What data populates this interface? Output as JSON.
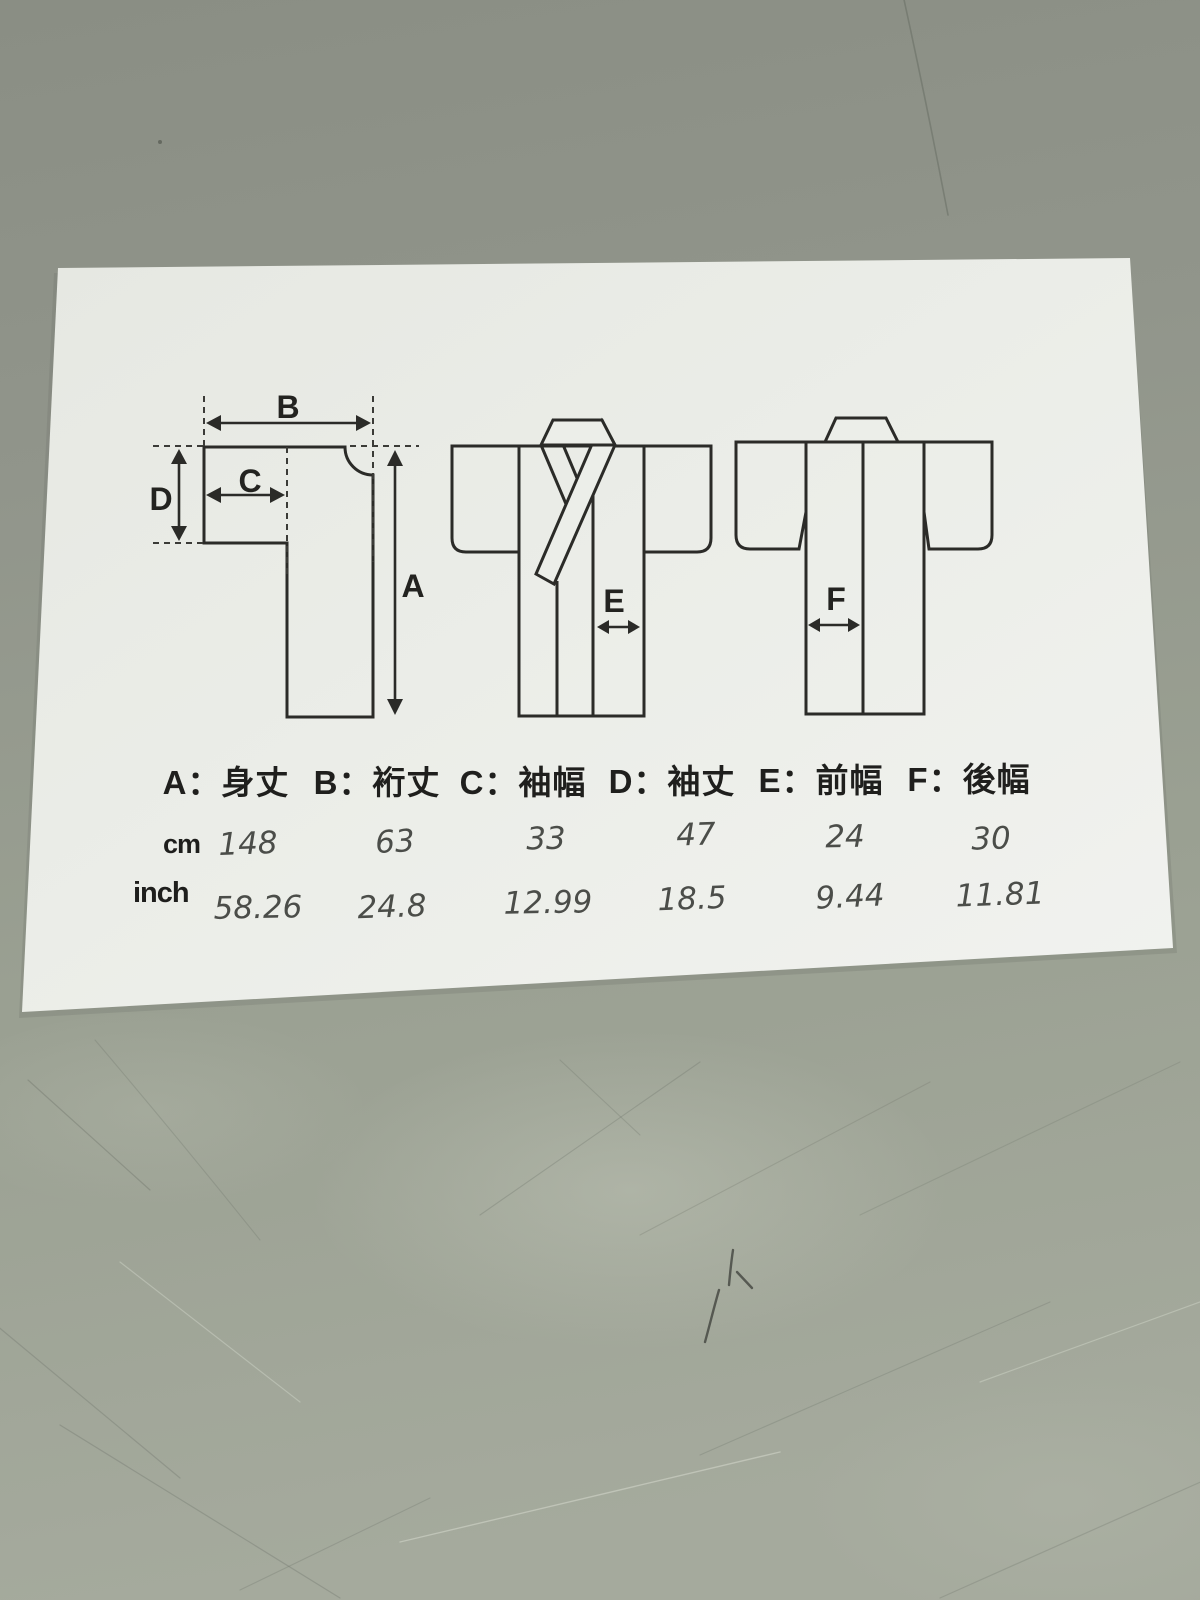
{
  "photo": {
    "subject": "kimono measurement size sheet lying on scratched table surface"
  },
  "diagram": {
    "labels": {
      "A": "A",
      "B": "B",
      "C": "C",
      "D": "D",
      "E": "E",
      "F": "F"
    }
  },
  "legend": {
    "separator": "：",
    "items": [
      {
        "key": "A",
        "name": "身丈",
        "label": "A：身丈"
      },
      {
        "key": "B",
        "name": "裄丈",
        "label": "B：裄丈"
      },
      {
        "key": "C",
        "name": "袖幅",
        "label": "C：袖幅"
      },
      {
        "key": "D",
        "name": "袖丈",
        "label": "D：袖丈"
      },
      {
        "key": "E",
        "name": "前幅",
        "label": "E：前幅"
      },
      {
        "key": "F",
        "name": "後幅",
        "label": "F：後幅"
      }
    ]
  },
  "table": {
    "unit_rows": [
      {
        "unit": "cm",
        "values": [
          "148",
          "63",
          "33",
          "47",
          "24",
          "30"
        ]
      },
      {
        "unit": "inch",
        "values": [
          "58.26",
          "24.8",
          "12.99",
          "18.5",
          "9.44",
          "11.81"
        ]
      }
    ]
  },
  "colors": {
    "paper": "#eceee9",
    "ink": "#2b2b28",
    "handwriting": "#4b4d49",
    "table_surface": "#969b8f"
  }
}
